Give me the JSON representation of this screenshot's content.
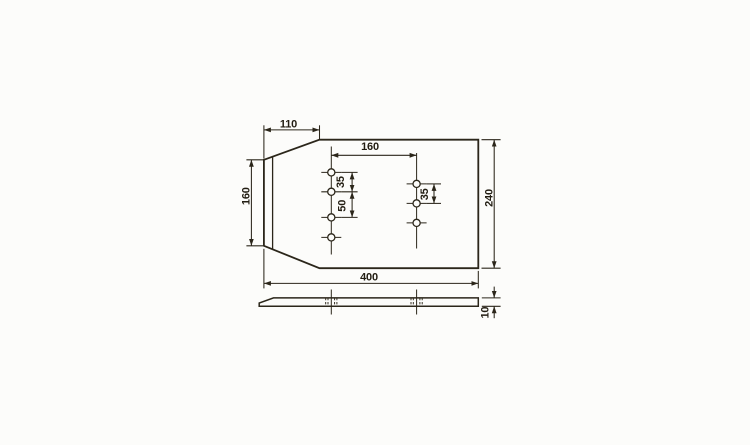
{
  "drawing": {
    "kind": "technical-drawing",
    "colors": {
      "background": "#fcfcfa",
      "line": "#2b261a",
      "text": "#221d12"
    },
    "holes": {
      "left_column_count": 4,
      "right_column_count": 3
    },
    "dimensions": {
      "taper_length": {
        "label": "110"
      },
      "hole_columns_spacing": {
        "label": "160"
      },
      "left_edge_height": {
        "label": "160"
      },
      "plate_height": {
        "label": "240"
      },
      "plate_width": {
        "label": "400"
      },
      "left_holes_pitch_top": {
        "label": "35"
      },
      "left_holes_pitch_middle": {
        "label": "50"
      },
      "right_holes_pitch": {
        "label": "35"
      },
      "thickness": {
        "label": "10"
      }
    }
  }
}
